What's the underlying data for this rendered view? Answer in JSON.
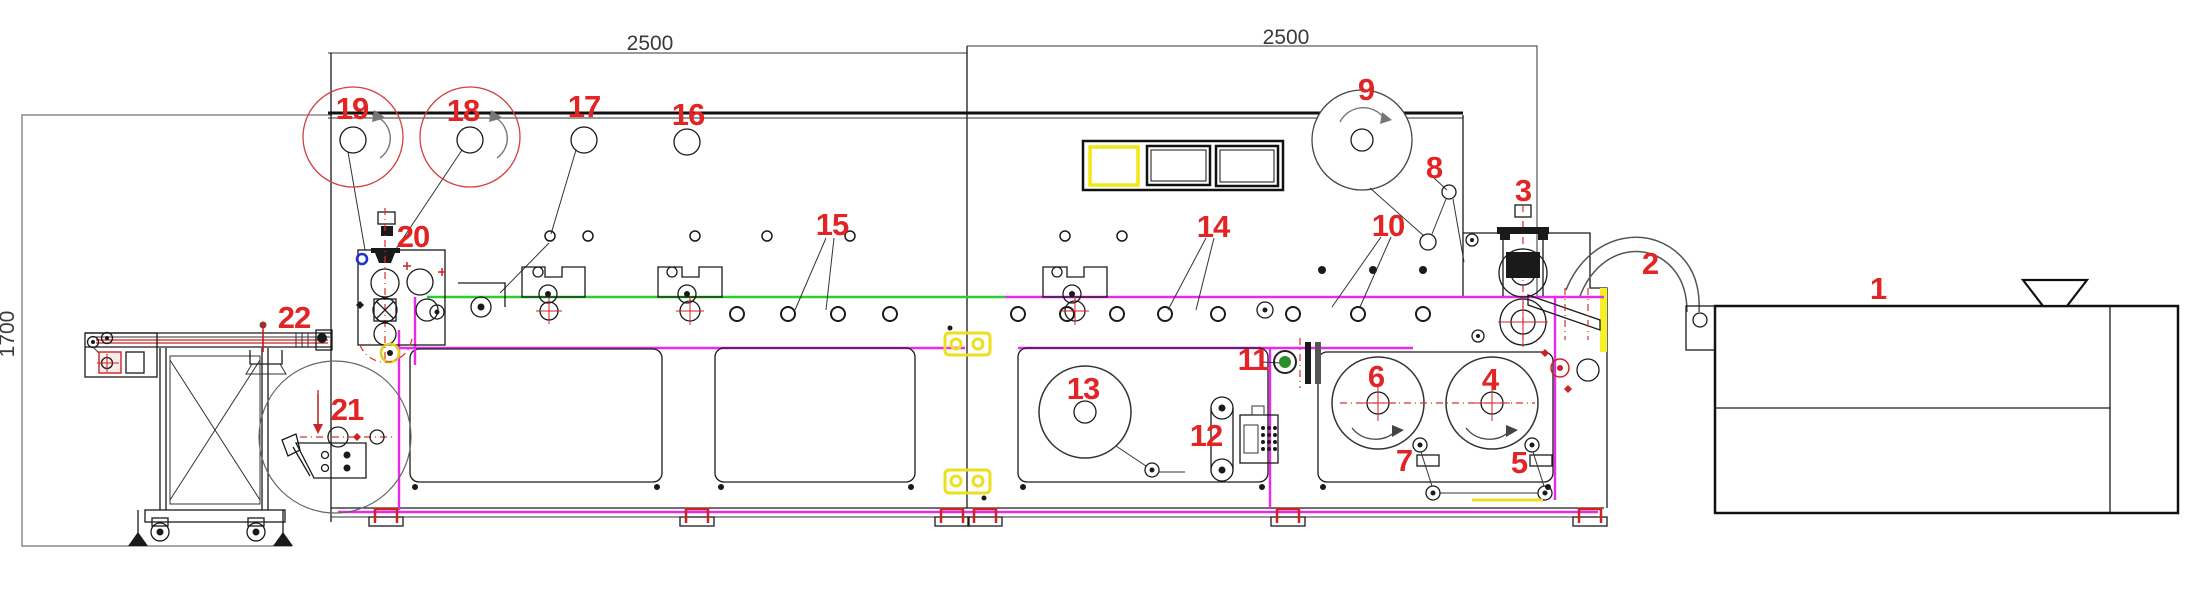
{
  "drawing": {
    "dimensions": {
      "section1_width": "2500",
      "section2_width": "2500",
      "machine_height": "1700"
    },
    "callouts": {
      "c1": "1",
      "c2": "2",
      "c3": "3",
      "c4": "4",
      "c5": "5",
      "c6": "6",
      "c7": "7",
      "c8": "8",
      "c9": "9",
      "c10": "10",
      "c11": "11",
      "c12": "12",
      "c13": "13",
      "c14": "14",
      "c15": "15",
      "c16": "16",
      "c17": "17",
      "c18": "18",
      "c19": "19",
      "c20": "20",
      "c21": "21",
      "c22": "22"
    }
  }
}
